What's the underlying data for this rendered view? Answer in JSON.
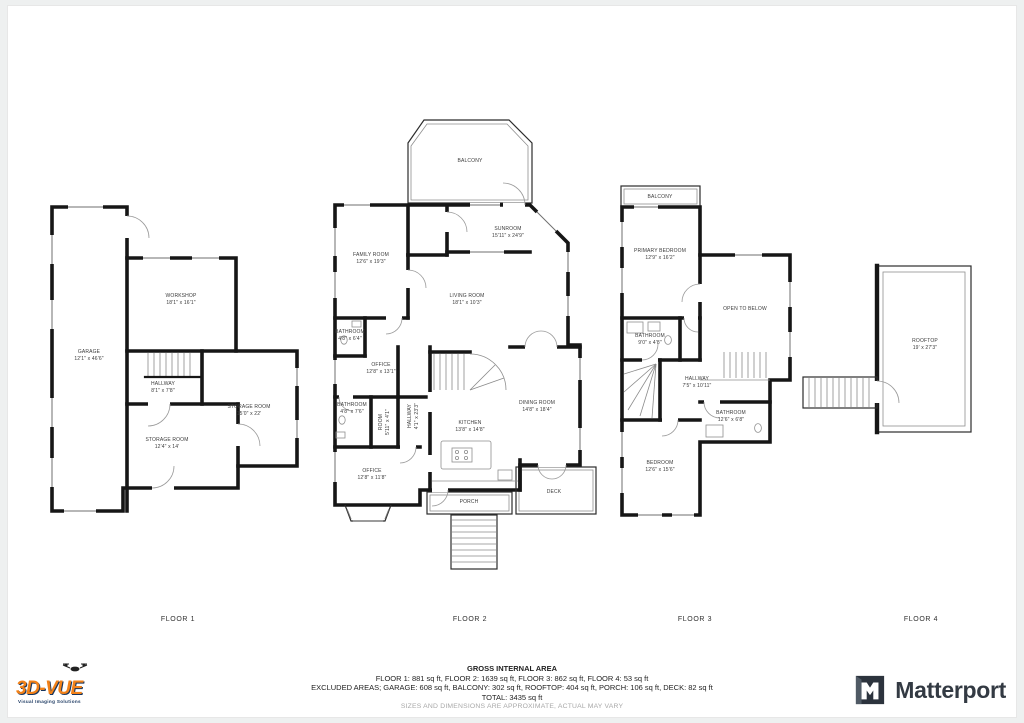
{
  "colors": {
    "wall": "#161616",
    "vendor_orange": "#f28118",
    "vendor_navy": "#17355e",
    "matterport_dark": "#333a43"
  },
  "floors": [
    {
      "label": "FLOOR 1",
      "rooms": [
        {
          "name": "GARAGE",
          "dims": "12'1\" x 46'6\""
        },
        {
          "name": "WORKSHOP",
          "dims": "18'1\" x 16'1\""
        },
        {
          "name": "HALLWAY",
          "dims": "8'1\" x 7'8\""
        },
        {
          "name": "STORAGE ROOM",
          "dims": "15'0\" x 22'"
        },
        {
          "name": "STORAGE ROOM",
          "dims": "12'4\" x 14'"
        }
      ]
    },
    {
      "label": "FLOOR 2",
      "rooms": [
        {
          "name": "BALCONY",
          "dims": ""
        },
        {
          "name": "FAMILY ROOM",
          "dims": "12'6\" x 19'3\""
        },
        {
          "name": "SUNROOM",
          "dims": "15'11\" x 24'9\""
        },
        {
          "name": "LIVING ROOM",
          "dims": "18'1\" x 10'3\""
        },
        {
          "name": "BATHROOM",
          "dims": "4'8\" x 6'4\""
        },
        {
          "name": "OFFICE",
          "dims": "12'8\" x 13'1\""
        },
        {
          "name": "BATHROOM",
          "dims": "4'8\" x 7'6\""
        },
        {
          "name": "ROOM",
          "dims": "5'11\" x 4'1\""
        },
        {
          "name": "HALLWAY",
          "dims": "4'1\" x 23'3\""
        },
        {
          "name": "KITCHEN",
          "dims": "13'8\" x 14'8\""
        },
        {
          "name": "DINING ROOM",
          "dims": "14'8\" x 18'4\""
        },
        {
          "name": "OFFICE",
          "dims": "12'8\" x 11'8\""
        },
        {
          "name": "PORCH",
          "dims": ""
        },
        {
          "name": "DECK",
          "dims": ""
        }
      ]
    },
    {
      "label": "FLOOR 3",
      "rooms": [
        {
          "name": "BALCONY",
          "dims": ""
        },
        {
          "name": "PRIMARY BEDROOM",
          "dims": "12'9\" x 16'2\""
        },
        {
          "name": "OPEN TO BELOW",
          "dims": ""
        },
        {
          "name": "BATHROOM",
          "dims": "9'0\" x 4'8\""
        },
        {
          "name": "HALLWAY",
          "dims": "7'5\" x 10'11\""
        },
        {
          "name": "BATHROOM",
          "dims": "12'6\" x 6'8\""
        },
        {
          "name": "BEDROOM",
          "dims": "12'6\" x 15'6\""
        }
      ]
    },
    {
      "label": "FLOOR 4",
      "rooms": [
        {
          "name": "ROOFTOP",
          "dims": "19' x 27'3\""
        }
      ]
    }
  ],
  "summary": {
    "title": "GROSS INTERNAL AREA",
    "line1": "FLOOR 1: 881 sq ft, FLOOR 2: 1639 sq ft, FLOOR 3: 862 sq ft, FLOOR 4: 53 sq ft",
    "line2": "EXCLUDED AREAS; GARAGE: 608 sq ft, BALCONY: 302 sq ft, ROOFTOP: 404 sq ft, PORCH: 106 sq ft, DECK: 82 sq ft",
    "total": "TOTAL: 3435 sq ft",
    "disclaimer": "SIZES AND DIMENSIONS ARE APPROXIMATE, ACTUAL MAY VARY"
  },
  "branding": {
    "vendor": {
      "text": "3D-VUE",
      "tagline": "Visual Imaging Solutions"
    },
    "matterport": {
      "name": "Matterport"
    }
  }
}
